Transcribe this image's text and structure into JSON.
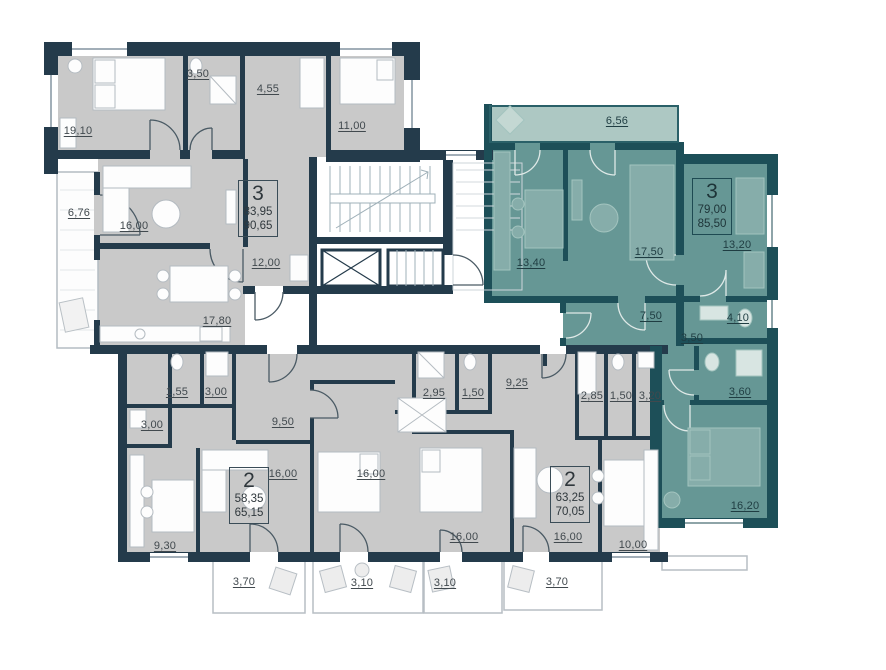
{
  "plan_name": "apartment-floor-plan",
  "colors": {
    "wall_gray": "#243b4b",
    "wall_teal": "#1d4f58",
    "floor_gray": "#c9c9c9",
    "floor_teal": "#669795",
    "balcony_teal": "#adc8c3",
    "background": "#ffffff"
  },
  "units": [
    {
      "id": "top-left",
      "rooms": "3",
      "living_area": "83,95",
      "total_area": "90,65",
      "highlighted": false
    },
    {
      "id": "top-right",
      "rooms": "3",
      "living_area": "79,00",
      "total_area": "85,50",
      "highlighted": true
    },
    {
      "id": "bottom-left",
      "rooms": "2",
      "living_area": "58,35",
      "total_area": "65,15",
      "highlighted": false
    },
    {
      "id": "bottom-right",
      "rooms": "2",
      "living_area": "63,25",
      "total_area": "70,05",
      "highlighted": false
    }
  ],
  "rooms": [
    {
      "name": "bedroom",
      "label": "19,10"
    },
    {
      "name": "bathroom",
      "label": "3,50"
    },
    {
      "name": "hall",
      "label": "4,55"
    },
    {
      "name": "bedroom",
      "label": "11,00"
    },
    {
      "name": "loggia",
      "label": "6,76"
    },
    {
      "name": "living-room",
      "label": "16,00"
    },
    {
      "name": "corridor",
      "label": "12,00"
    },
    {
      "name": "kitchen",
      "label": "17,80"
    },
    {
      "name": "balcony",
      "label": "6,56"
    },
    {
      "name": "kitchen",
      "label": "13,40"
    },
    {
      "name": "living-room",
      "label": "17,50"
    },
    {
      "name": "bedroom",
      "label": "13,20"
    },
    {
      "name": "corridor",
      "label": "7,50"
    },
    {
      "name": "hall",
      "label": "3,50"
    },
    {
      "name": "bathroom",
      "label": "4,10"
    },
    {
      "name": "bathroom",
      "label": "3,60"
    },
    {
      "name": "bedroom",
      "label": "16,20"
    },
    {
      "name": "wc",
      "label": "1,55"
    },
    {
      "name": "bathroom",
      "label": "3,00"
    },
    {
      "name": "bathroom",
      "label": "3,00"
    },
    {
      "name": "hall",
      "label": "9,50"
    },
    {
      "name": "living-room",
      "label": "16,00"
    },
    {
      "name": "kitchen",
      "label": "9,30"
    },
    {
      "name": "bedroom",
      "label": "16,00"
    },
    {
      "name": "bathroom",
      "label": "2,95"
    },
    {
      "name": "wc",
      "label": "1,50"
    },
    {
      "name": "hall",
      "label": "9,25"
    },
    {
      "name": "bathroom",
      "label": "2,85"
    },
    {
      "name": "wc",
      "label": "1,50"
    },
    {
      "name": "storage",
      "label": "3,20"
    },
    {
      "name": "bedroom",
      "label": "16,00"
    },
    {
      "name": "living-room",
      "label": "16,00"
    },
    {
      "name": "kitchen",
      "label": "10,00"
    },
    {
      "name": "balcony",
      "label": "3,70"
    },
    {
      "name": "balcony",
      "label": "3,10"
    },
    {
      "name": "balcony",
      "label": "3,10"
    },
    {
      "name": "balcony",
      "label": "3,70"
    }
  ]
}
